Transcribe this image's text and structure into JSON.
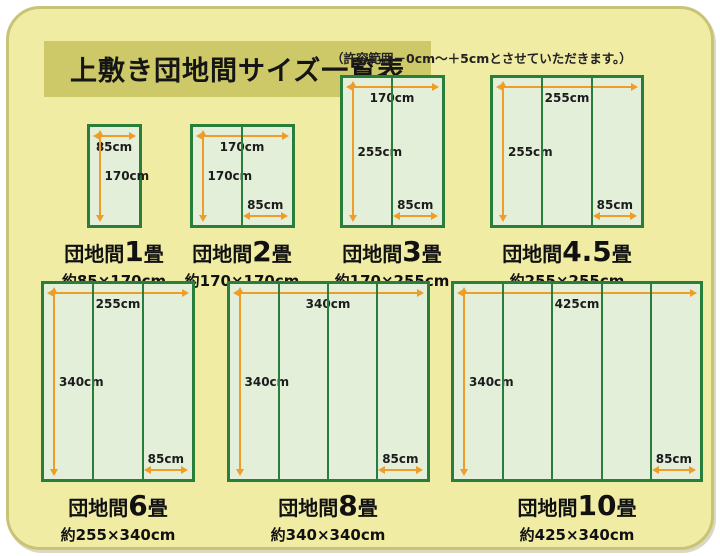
{
  "title": "上敷き団地間サイズ一覧表",
  "note": "（許容範囲－0cm～＋5cmとさせていただきます。）",
  "colors": {
    "panel_bg": "#f1eca4",
    "panel_border": "#c9c377",
    "title_bg": "#cdc868",
    "mat_fill": "#e3efd9",
    "mat_border": "#2a7e3b",
    "arrow": "#ef9d28",
    "label_text": "#1c1c1c"
  },
  "diagrams": [
    {
      "row": 1,
      "columns": 1,
      "width_cm": 85,
      "height_cm": 170,
      "top_label": "85cm",
      "side_label": "170cm",
      "bottom_label": null,
      "caption_prefix": "団地間",
      "caption_num": "1",
      "caption_suffix": "畳",
      "subtitle": "約85×170cm"
    },
    {
      "row": 1,
      "columns": 2,
      "width_cm": 170,
      "height_cm": 170,
      "top_label": "170cm",
      "side_label": "170cm",
      "bottom_label": "85cm",
      "caption_prefix": "団地間",
      "caption_num": "2",
      "caption_suffix": "畳",
      "subtitle": "約170×170cm"
    },
    {
      "row": 1,
      "columns": 2,
      "width_cm": 170,
      "height_cm": 255,
      "top_label": "170cm",
      "side_label": "255cm",
      "bottom_label": "85cm",
      "caption_prefix": "団地間",
      "caption_num": "3",
      "caption_suffix": "畳",
      "subtitle": "約170×255cm"
    },
    {
      "row": 1,
      "columns": 3,
      "width_cm": 255,
      "height_cm": 255,
      "top_label": "255cm",
      "side_label": "255cm",
      "bottom_label": "85cm",
      "caption_prefix": "団地間",
      "caption_num": "4.5",
      "caption_suffix": "畳",
      "subtitle": "約255×255cm"
    },
    {
      "row": 2,
      "columns": 3,
      "width_cm": 255,
      "height_cm": 340,
      "top_label": "255cm",
      "side_label": "340cm",
      "bottom_label": "85cm",
      "caption_prefix": "団地間",
      "caption_num": "6",
      "caption_suffix": "畳",
      "subtitle": "約255×340cm"
    },
    {
      "row": 2,
      "columns": 4,
      "width_cm": 340,
      "height_cm": 340,
      "top_label": "340cm",
      "side_label": "340cm",
      "bottom_label": "85cm",
      "caption_prefix": "団地間",
      "caption_num": "8",
      "caption_suffix": "畳",
      "subtitle": "約340×340cm"
    },
    {
      "row": 2,
      "columns": 5,
      "width_cm": 425,
      "height_cm": 340,
      "top_label": "425cm",
      "side_label": "340cm",
      "bottom_label": "85cm",
      "caption_prefix": "団地間",
      "caption_num": "10",
      "caption_suffix": "畳",
      "subtitle": "約425×340cm"
    }
  ]
}
